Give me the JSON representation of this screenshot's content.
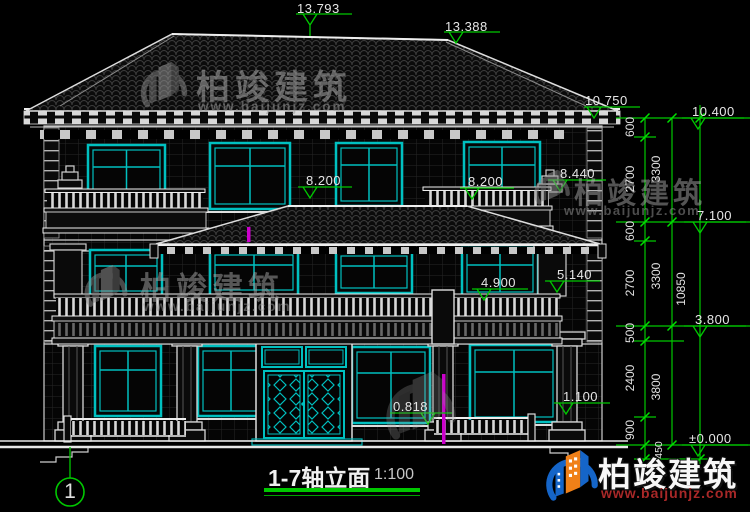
{
  "sheet": {
    "title": "1-7轴立面",
    "scale": "1:100",
    "axis": "1"
  },
  "markers": {
    "ridge_main": "13.793",
    "ridge_right": "13.388",
    "cornice_top": "10.750",
    "eave": "10.400",
    "parapet3": "8.440",
    "rail3_left": "8.200",
    "rail3_right": "8.200",
    "level3": "7.100",
    "parapet2": "5.140",
    "rail2": "4.900",
    "level2": "3.800",
    "sill1": "1.100",
    "porch": "0.818",
    "ground": "±0.000"
  },
  "dimensions": {
    "segments": [
      "600",
      "2700",
      "600",
      "2700",
      "500",
      "2400",
      "900",
      "450"
    ],
    "stories": [
      "3300",
      "3300",
      "3800"
    ],
    "overall": "10850"
  },
  "watermark": {
    "brand": "柏竣建筑",
    "url": "www.baijunjz.com"
  },
  "badge": {
    "brand": "柏竣建筑",
    "url": "www.baijunjz.com"
  },
  "colors": {
    "dimension_green": "#00c800",
    "window_cyan": "#00c0c0",
    "highlight_magenta": "#cc00cc",
    "brand_blue": "#1565c8",
    "brand_orange": "#f08018",
    "url_red": "#a82828"
  }
}
